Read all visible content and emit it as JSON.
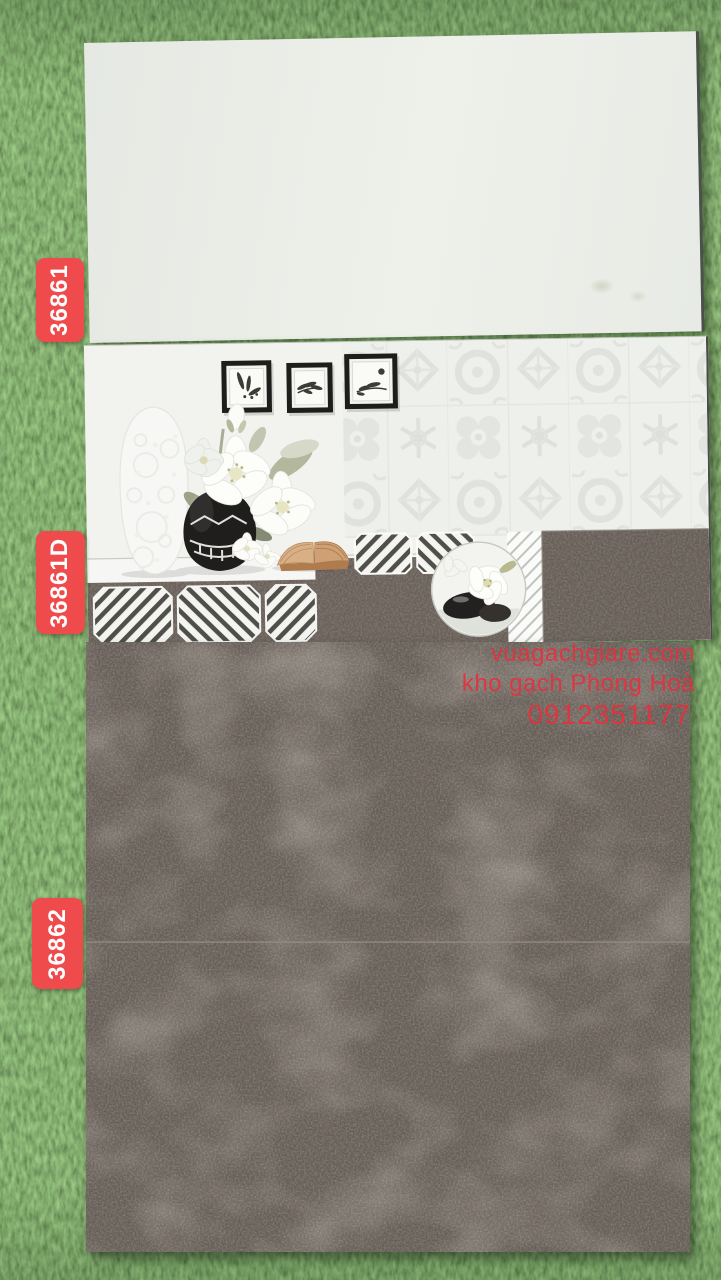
{
  "labels": [
    {
      "code": "36861"
    },
    {
      "code": "36861D"
    },
    {
      "code": "36862"
    }
  ],
  "watermark": {
    "line1": "vuagachgiare.com",
    "line2": "kho gạch Phong Hoà",
    "line3": "0912351177"
  },
  "colors": {
    "label_red": "#ef4b4c",
    "watermark_red": "#e5313e",
    "grass_green": "#3f6a2c",
    "plain_tile_white": "#eaece6",
    "decor_tile_base": "#f1f2ee",
    "dark_tile_gray": "#665e57"
  }
}
